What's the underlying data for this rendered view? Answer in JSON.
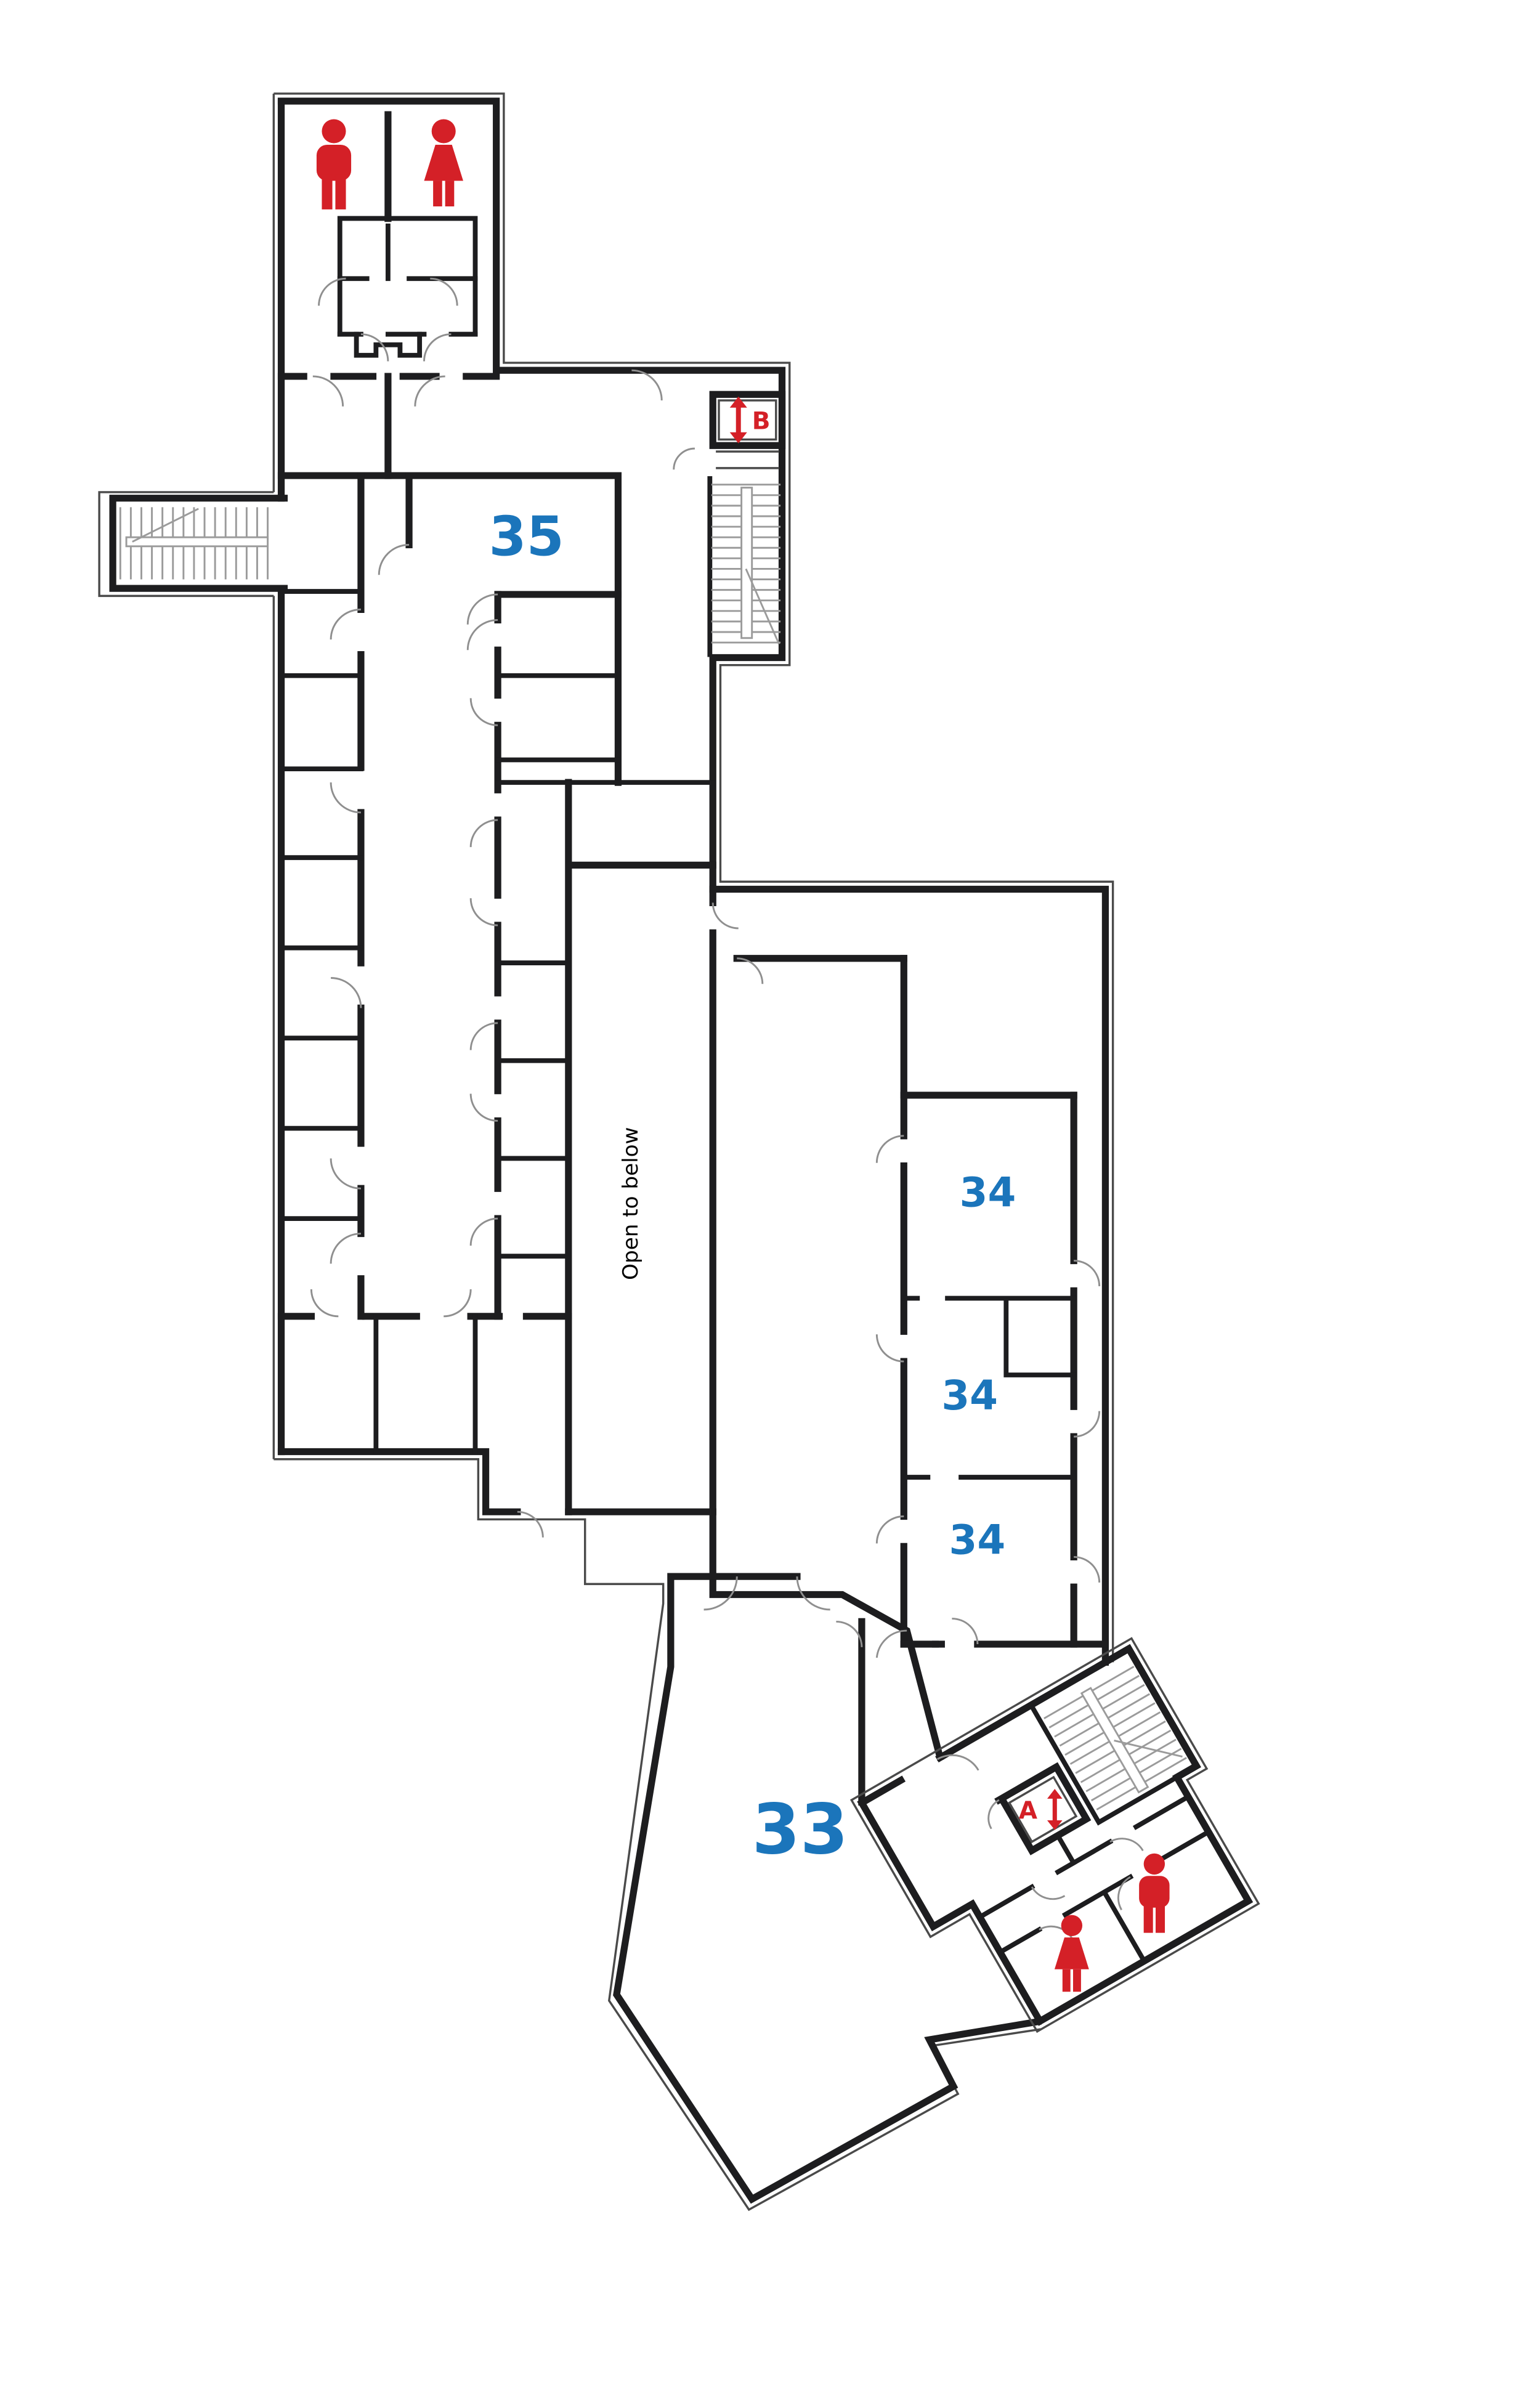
{
  "page": {
    "background": "#ffffff",
    "type": "floor-plan-diagram"
  },
  "colors": {
    "wall": "#1d1d1f",
    "outer_shell": "#4a4a4a",
    "door_arc": "#8f8f8f",
    "stair_line": "#9b9b9b",
    "accent_red": "#d42027",
    "accent_blue": "#1b75bb",
    "text_black": "#000000"
  },
  "labels": {
    "room_35": "35",
    "room_34_upper": "34",
    "room_34_middle": "34",
    "room_34_lower": "34",
    "room_33": "33",
    "open_to_below": "Open to below"
  },
  "elevators": {
    "elevator_a_letter": "A",
    "elevator_b_letter": "B"
  },
  "icons": {
    "north_block": [
      "mens-room-icon",
      "womens-room-icon"
    ],
    "south_wing": [
      "womens-room-icon",
      "mens-room-icon"
    ],
    "elevator_symbol": "up-down-arrow-icon"
  }
}
